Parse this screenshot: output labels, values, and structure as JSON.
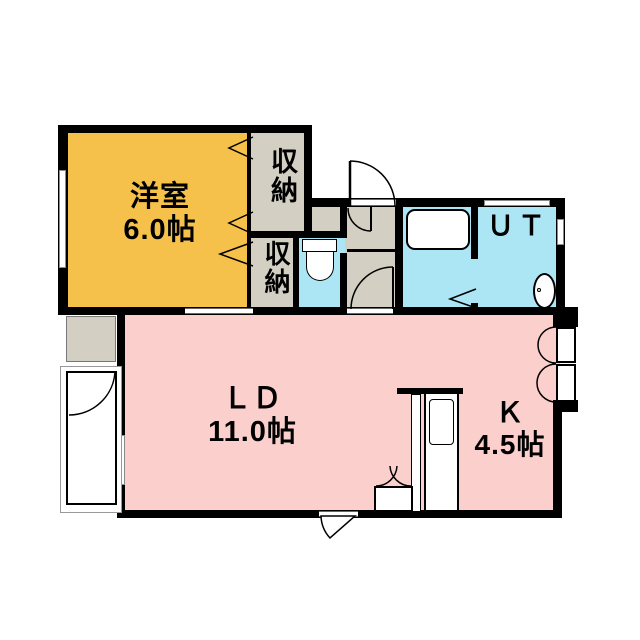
{
  "floorplan": {
    "rooms": {
      "western": {
        "label": "洋室",
        "size": "6.0帖",
        "color": "#f6c14b"
      },
      "living_dining": {
        "label": "ＬＤ",
        "size": "11.0帖",
        "color": "#fbcfcc"
      },
      "kitchen": {
        "label": "Ｋ",
        "size": "4.5帖",
        "color": "#fbcfcc"
      },
      "utility": {
        "label": "ＵＴ",
        "color": "#ace6f5"
      },
      "storage_upper": {
        "label": "収納",
        "color": "#d3d0c3"
      },
      "storage_lower": {
        "label": "収納",
        "color": "#d3d0c3"
      },
      "toilet": {
        "color": "#ace6f5"
      },
      "bathroom": {
        "color": "#ace6f5"
      },
      "hall": {
        "color": "#d3d0c3"
      }
    },
    "colors": {
      "wall": "#000000",
      "background": "#ffffff",
      "fixture_white": "#ffffff"
    },
    "symbols": {
      "entrance_door": "quarter-arc swing door",
      "toilet": "tank and bowl",
      "bathtub": "rounded rectangle",
      "washer_pan": "oval with drain dot",
      "kitchen_counter": "counter with sink",
      "closet_doors": "double swing arcs",
      "door_chevrons": "fold-door markers"
    }
  }
}
